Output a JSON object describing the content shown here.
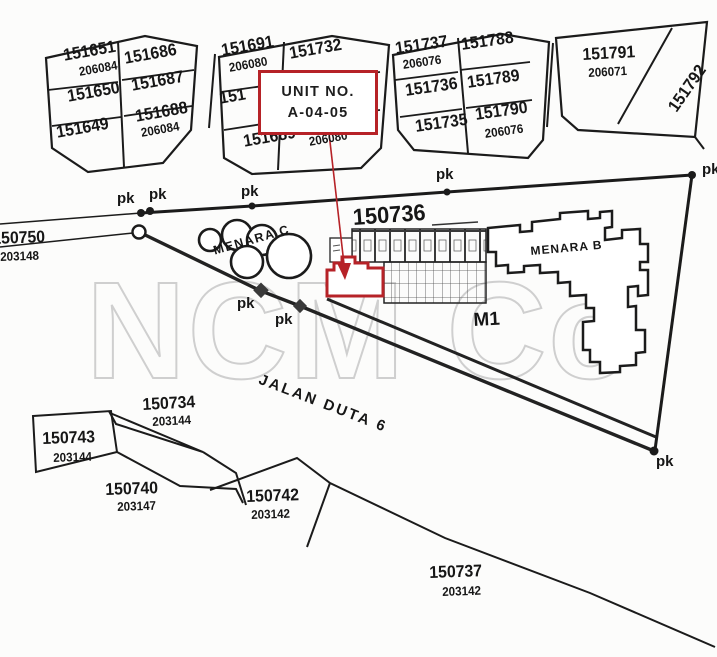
{
  "annotation": {
    "title": "UNIT NO.",
    "unit": "A-04-05",
    "accent_color": "#b62227"
  },
  "watermark": {
    "text": "NCM Co",
    "tm_mark": "TM"
  },
  "road": {
    "name": "JALAN DUTA 6"
  },
  "buildings": {
    "menara_c": "MENARA C",
    "menara_b": "MENARA B",
    "m1": "M1"
  },
  "markers": {
    "pk": "pk"
  },
  "colors": {
    "ink": "#1b1b1b",
    "red": "#b62227",
    "watermark_gray": "#cfcfcf"
  },
  "parcels": {
    "main_lot": {
      "number": "150736"
    },
    "left_lot": {
      "number": "150750",
      "ref": "203148"
    },
    "top_row": [
      {
        "lots": [
          "151651",
          "151686",
          "151650",
          "151687",
          "151649",
          "151688"
        ],
        "plan_refs": [
          "206084",
          "206084"
        ]
      },
      {
        "lots": [
          "151691",
          "151732",
          "151",
          "151689"
        ],
        "plan_refs": [
          "206080",
          "206080"
        ]
      },
      {
        "lots": [
          "151737",
          "151788",
          "151736",
          "151789",
          "151735",
          "151790"
        ],
        "plan_refs": [
          "206076",
          "206076"
        ]
      },
      {
        "lots": [
          "151791",
          "151792"
        ],
        "plan_refs": [
          "206071"
        ]
      }
    ],
    "bottom": [
      {
        "number": "150734",
        "ref": "203144"
      },
      {
        "number": "150743",
        "ref": "203144"
      },
      {
        "number": "150740",
        "ref": "203147"
      },
      {
        "number": "150742",
        "ref": "203142"
      },
      {
        "number": "150737",
        "ref": "203142"
      }
    ]
  }
}
